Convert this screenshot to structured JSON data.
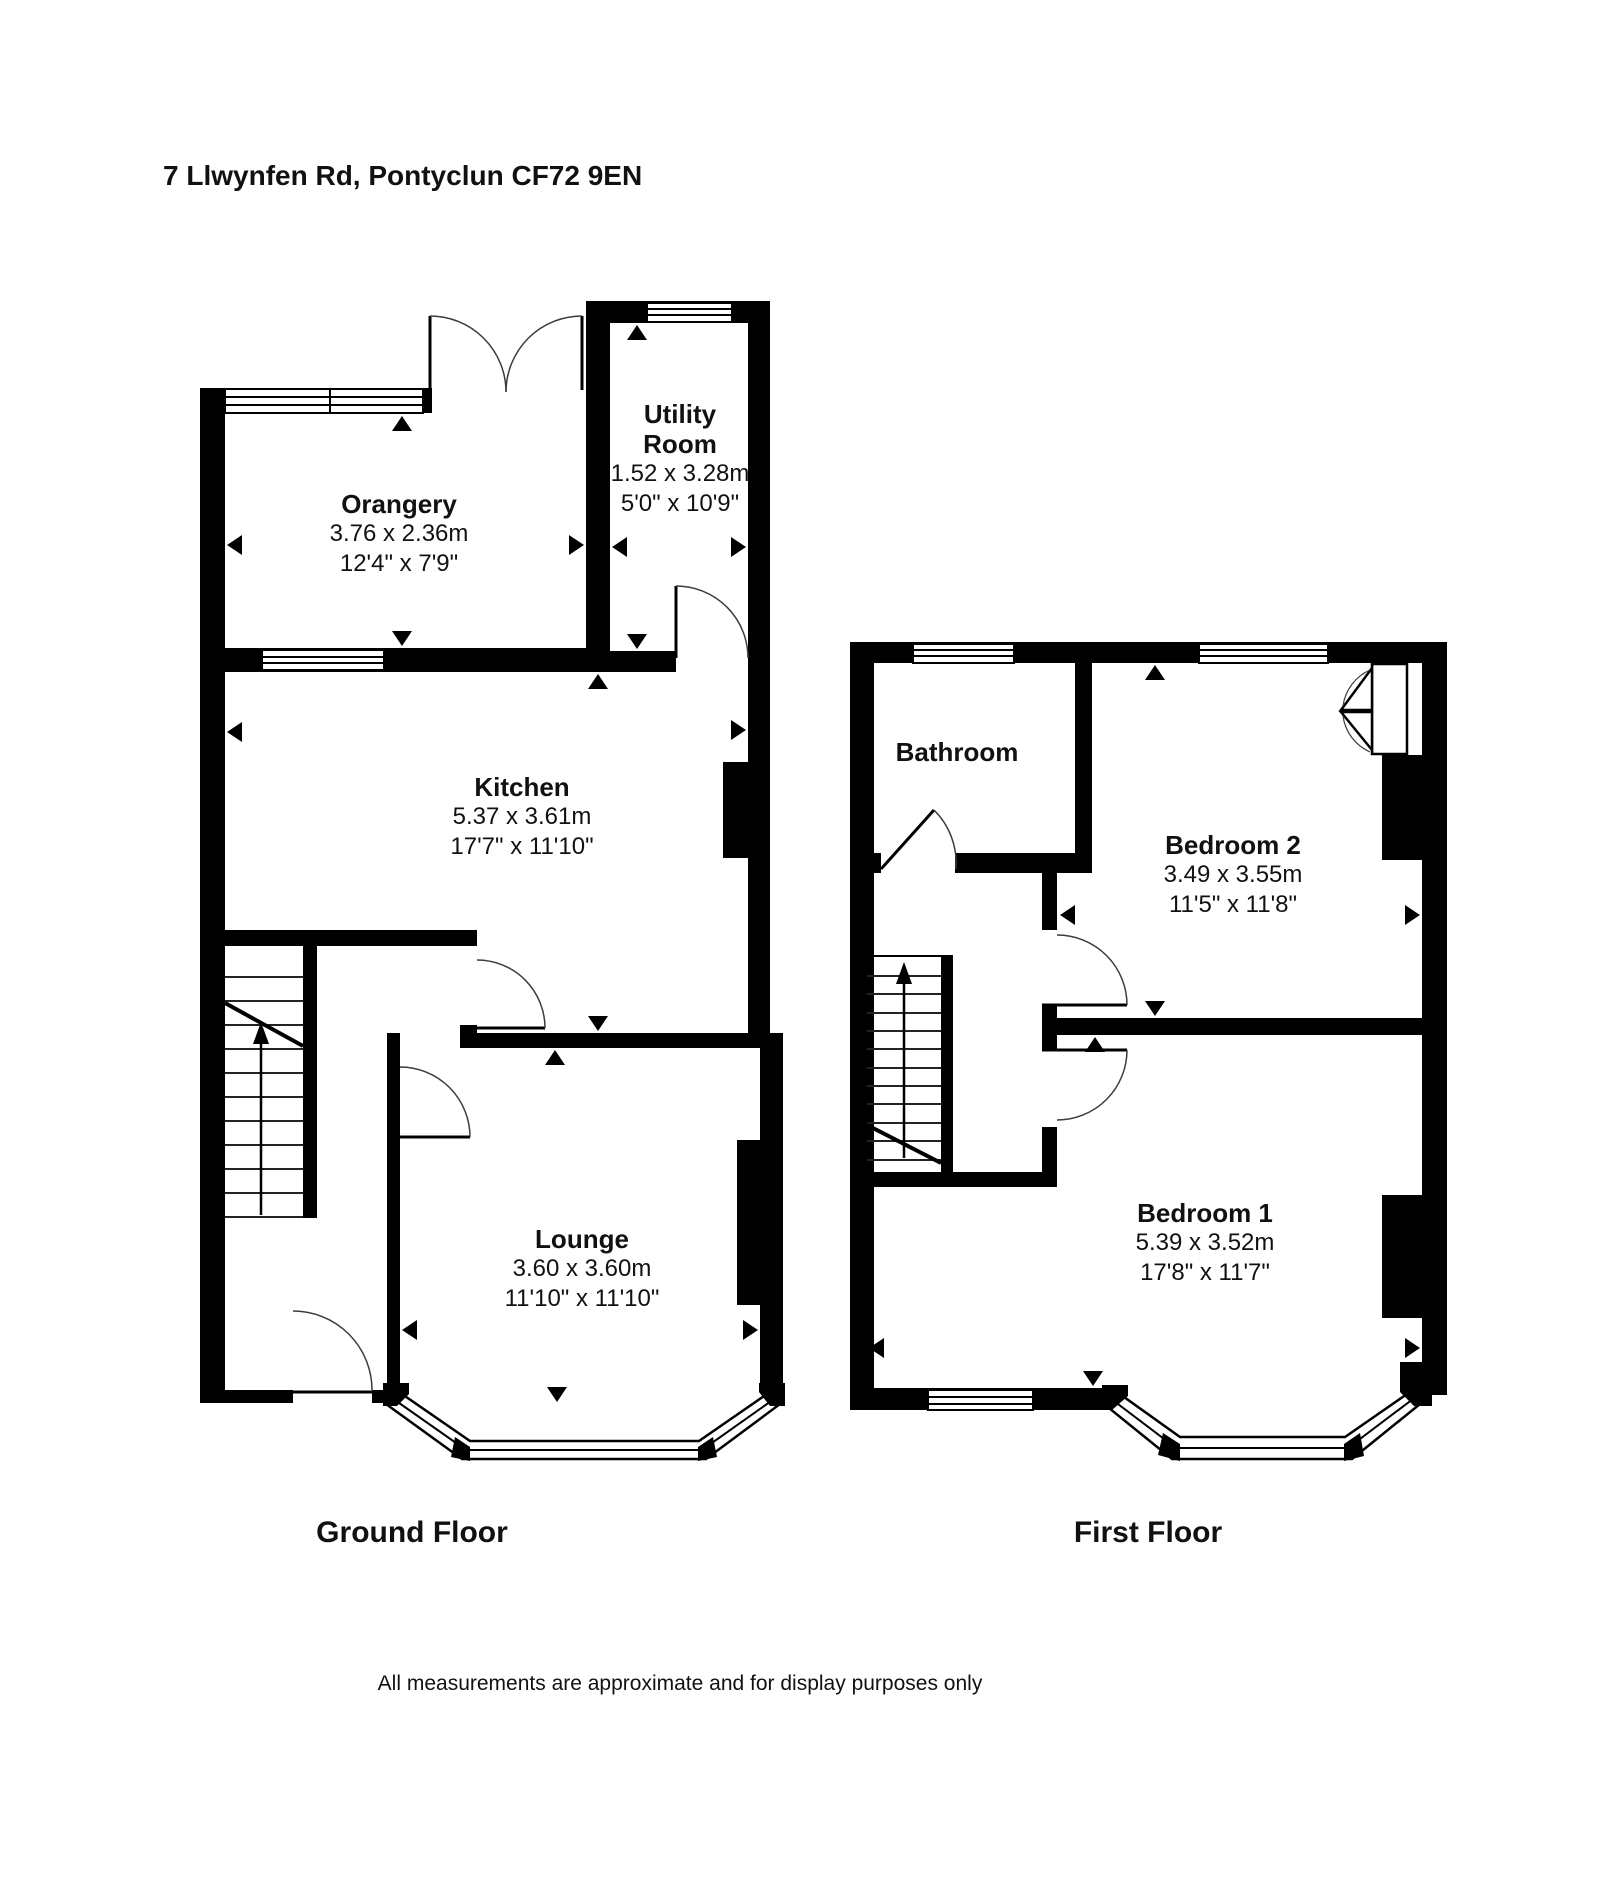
{
  "page": {
    "title": "7 Llwynfen Rd, Pontyclun CF72 9EN",
    "disclaimer": "All measurements are approximate and for display purposes only"
  },
  "floors": [
    {
      "label": "Ground Floor",
      "rooms": [
        {
          "name": "Orangery",
          "metric": "3.76 x 2.36m",
          "imperial": "12'4\" x 7'9\""
        },
        {
          "name": "Utility Room",
          "metric": "1.52 x 3.28m",
          "imperial": "5'0\" x 10'9\""
        },
        {
          "name": "Kitchen",
          "metric": "5.37 x 3.61m",
          "imperial": "17'7\" x 11'10\""
        },
        {
          "name": "Lounge",
          "metric": "3.60 x 3.60m",
          "imperial": "11'10\" x 11'10\""
        }
      ]
    },
    {
      "label": "First Floor",
      "rooms": [
        {
          "name": "Bathroom"
        },
        {
          "name": "Bedroom 2",
          "metric": "3.49 x 3.55m",
          "imperial": "11'5\" x 11'8\""
        },
        {
          "name": "Bedroom 1",
          "metric": "5.39 x 3.52m",
          "imperial": "17'8\" x 11'7\""
        }
      ]
    }
  ],
  "colors": {
    "wall": "#000000",
    "background": "#ffffff",
    "door_arc": "#3c3c3c"
  }
}
